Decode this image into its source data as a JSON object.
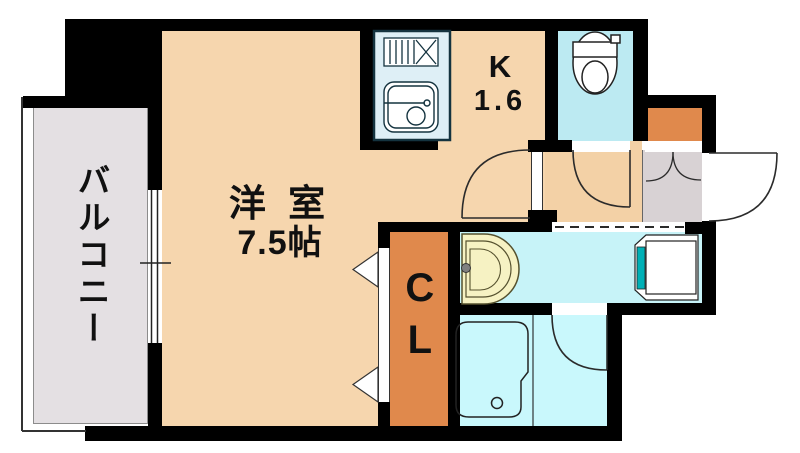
{
  "plan_title": "studio-apartment-floor-plan",
  "rooms": {
    "living": {
      "name": "洋 室",
      "size": "7.5帖"
    },
    "kitchen": {
      "name": "K",
      "size": "1.6"
    },
    "closet": {
      "name": "CL"
    },
    "balcony": {
      "name": "バルコニー"
    }
  },
  "fixtures": [
    "kitchen-counter",
    "stove-icon",
    "sink-icon",
    "toilet-icon",
    "washbasin-icon",
    "washing-machine-pan-icon",
    "bathtub-icon",
    "window-symbol",
    "door-swing-arcs",
    "closet-door-triangles"
  ],
  "colors": {
    "room": "#F6D6AE",
    "hall": "#F3D1A6",
    "balcony": "#E4E0E3",
    "entrance": "#D8D2D4",
    "toilet": "#BCEAF2",
    "washroom": "#C7F3F8",
    "bathroom": "#C9F8FC",
    "closet": "#E0894C",
    "counter": "#DEEFF6",
    "basin": "#F6F2C3",
    "teal": "#00B0B6",
    "wall": "#000000"
  }
}
